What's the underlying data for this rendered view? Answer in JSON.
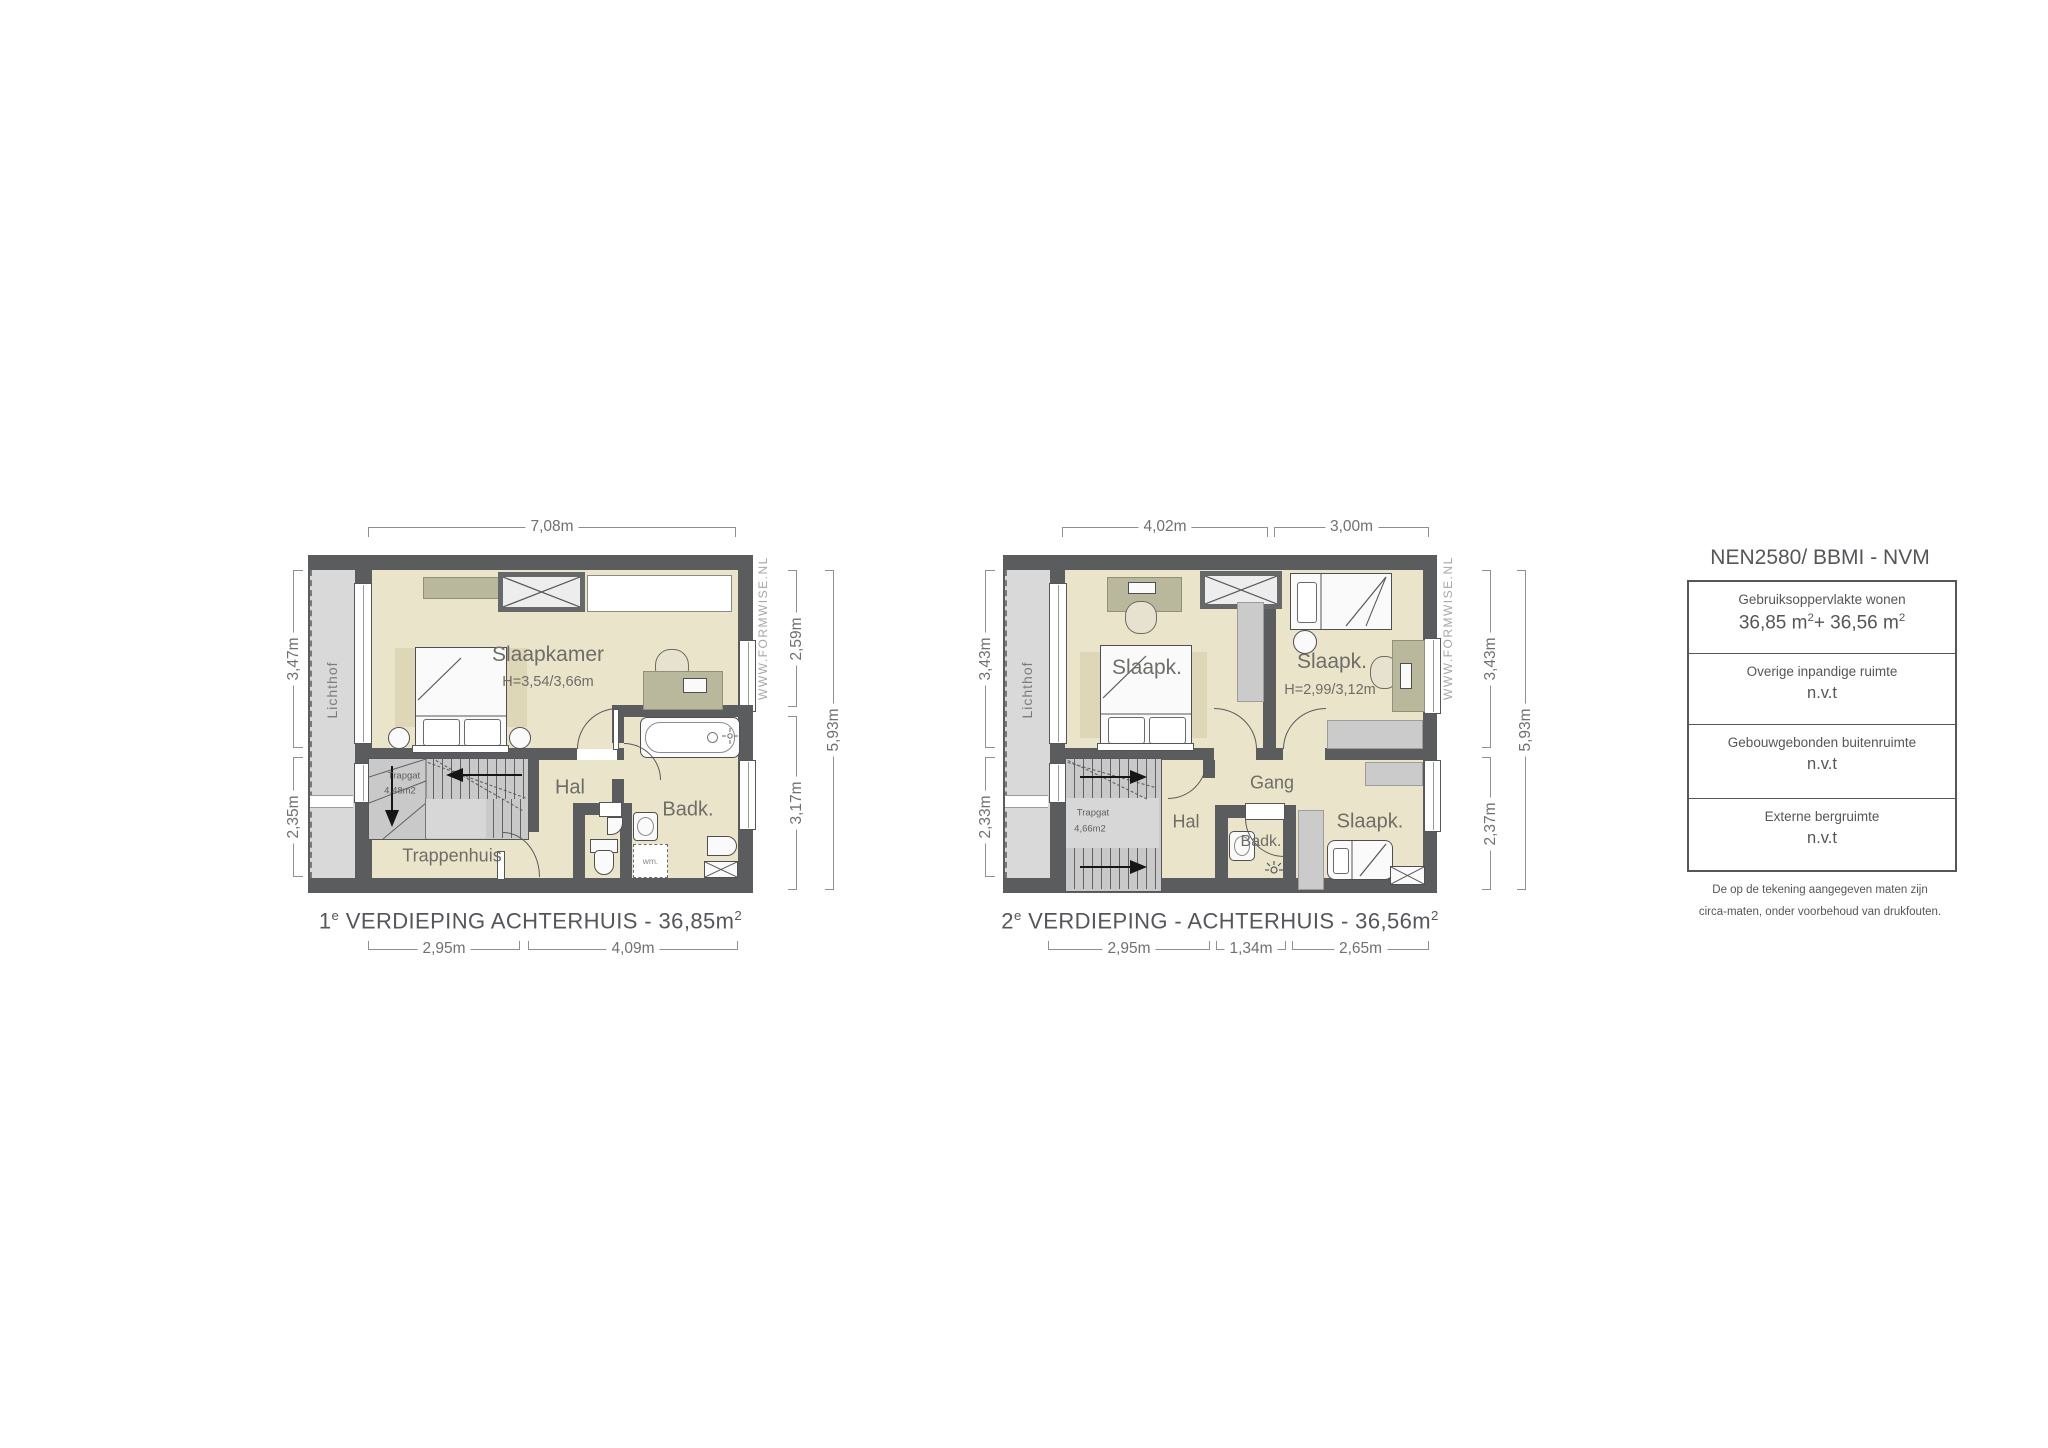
{
  "watermark": "WWW.FORMWISE.NL",
  "colors": {
    "wall": "#5b5c5e",
    "floor": "#eae5ca",
    "lichthof": "#d9d9d9",
    "stairs": "#c9c9c9",
    "rug": "#ddd7b8",
    "furniture_accent": "#b9b89c",
    "dim_text": "#707070",
    "label_text": "#6e6d68"
  },
  "plan1": {
    "title": {
      "num": "1",
      "sup": "e",
      "rest": " VERDIEPING ACHTERHUIS - 36,85m",
      "sup2": "2"
    },
    "dims": {
      "top": "7,08m",
      "left_upper": "3,47m",
      "left_lower": "2,35m",
      "right_upper": "2,59m",
      "right_lower": "3,17m",
      "right_total": "5,93m",
      "bottom_left": "2,95m",
      "bottom_right": "4,09m"
    },
    "rooms": {
      "slaapkamer": "Slaapkamer",
      "slaapkamer_height": "H=3,54/3,66m",
      "hal": "Hal",
      "badk": "Badk.",
      "trappenhuis": "Trappenhuis",
      "trapgat": "Trapgat",
      "trapgat_area": "4,48m2",
      "lichthof": "Lichthof",
      "wm": "wm."
    }
  },
  "plan2": {
    "title": {
      "num": "2",
      "sup": "e",
      "rest": " VERDIEPING - ACHTERHUIS - 36,56m",
      "sup2": "2"
    },
    "dims": {
      "top_left": "4,02m",
      "top_right": "3,00m",
      "left_upper": "3,43m",
      "left_lower": "2,33m",
      "right_upper": "3,43m",
      "right_lower": "2,37m",
      "right_total": "5,93m",
      "bottom_left": "2,95m",
      "bottom_middle": "1,34m",
      "bottom_right": "2,65m"
    },
    "rooms": {
      "slaapk_left": "Slaapk.",
      "slaapk_right": "Slaapk.",
      "slaapk_right_height": "H=2,99/3,12m",
      "slaapk_bottom": "Slaapk.",
      "gang": "Gang",
      "hal": "Hal",
      "badk": "Badk.",
      "trapgat": "Trapgat",
      "trapgat_area": "4,66m2",
      "lichthof": "Lichthof"
    }
  },
  "legend": {
    "title": "NEN2580/ BBMI - NVM",
    "rows": [
      {
        "label": "Gebruiksoppervlakte wonen",
        "value": {
          "a": "36,85 m",
          "asup": "2",
          "b": "+ 36,56 m",
          "bsup": "2"
        }
      },
      {
        "label": "Overige inpandige ruimte",
        "value_text": "n.v.t"
      },
      {
        "label": "Gebouwgebonden buitenruimte",
        "value_text": "n.v.t"
      },
      {
        "label": "Externe bergruimte",
        "value_text": "n.v.t"
      }
    ],
    "note1": "De op de tekening aangegeven maten zijn",
    "note2": "circa-maten, onder voorbehoud van drukfouten."
  }
}
